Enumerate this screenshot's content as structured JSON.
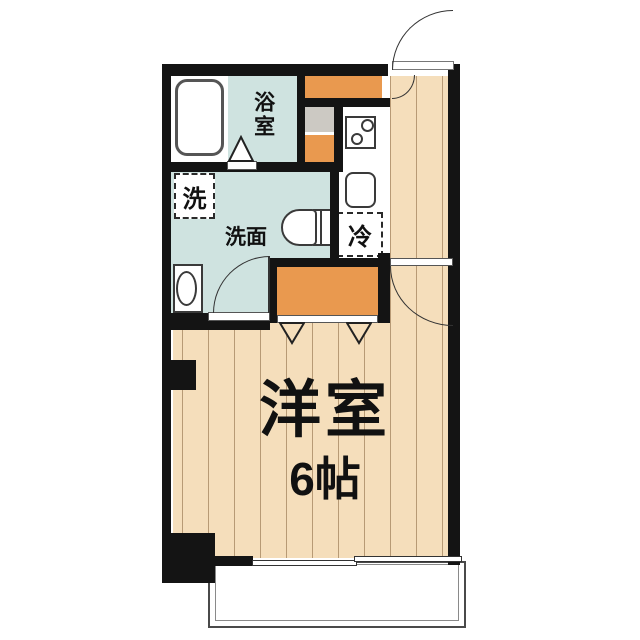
{
  "floorplan": {
    "type": "japanese-apartment-1R",
    "labels": {
      "bathroom": "浴室",
      "washer_space": "洗",
      "washroom": "洗面",
      "fridge_space": "冷",
      "main_room": "洋室",
      "main_room_size": "6帖"
    },
    "colors": {
      "wall": "#141414",
      "wet_area_floor": "#cfe3e0",
      "wood_floor": "#f5debb",
      "storage_orange": "#e9994f",
      "counter_gray": "#ccc9c3"
    }
  }
}
